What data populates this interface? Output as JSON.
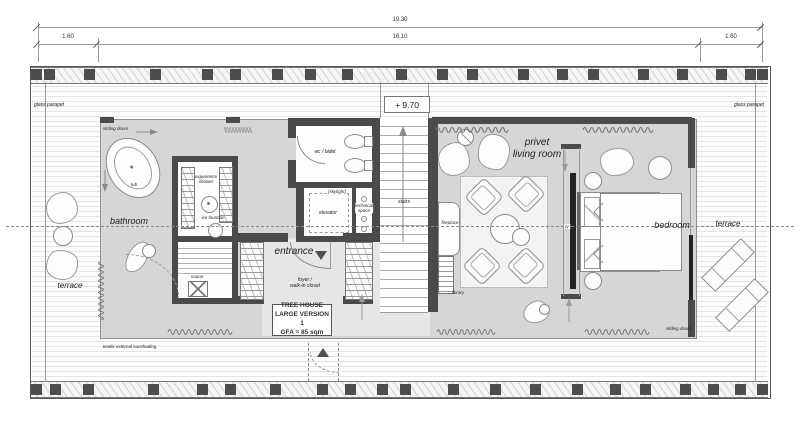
{
  "dimensions": {
    "total": "19.30",
    "left": "1.60",
    "middle": "16.10",
    "right": "1.60"
  },
  "level_marker": "+ 9.70",
  "info_box": {
    "line1": "TREE HOUSE",
    "line2": "LARGE VERSION 1",
    "line3": "GFA = 85 sqm"
  },
  "rooms": {
    "bathroom": "bathroom",
    "terrace_left": "terrace",
    "terrace_right": "terrace",
    "entrance": "entrance",
    "foyer_line1": "foyer /",
    "foyer_line2": "walk-in closet",
    "living_line1": "privet",
    "living_line2": "living room",
    "bedroom": "bedroom",
    "stairs": "stairs",
    "elevator": "elevator",
    "wc": "wc / bidet",
    "skylight": "(skylight)",
    "technical_line1": "technical",
    "technical_line2": "space",
    "sauna": "sauna"
  },
  "fixtures": {
    "tub": "tub",
    "shower_line1": "experience",
    "shower_line2": "shower",
    "ice_fountain": "ice fountain",
    "fireplace": "fireplace",
    "library": "library",
    "tv": "tv"
  },
  "annotations": {
    "glass_parapet_left": "glass parapet",
    "glass_parapet_right": "glass parapet",
    "sliding_doors_top": "sliding doors",
    "sliding_doors_bottom": "sliding doors",
    "sunshading": "textile external sunshading"
  },
  "colors": {
    "wall": "#4a4a4a",
    "interior_floor": "#d6d6d6",
    "foyer_floor": "#e6e6e6",
    "accent_dark": "#242424"
  }
}
